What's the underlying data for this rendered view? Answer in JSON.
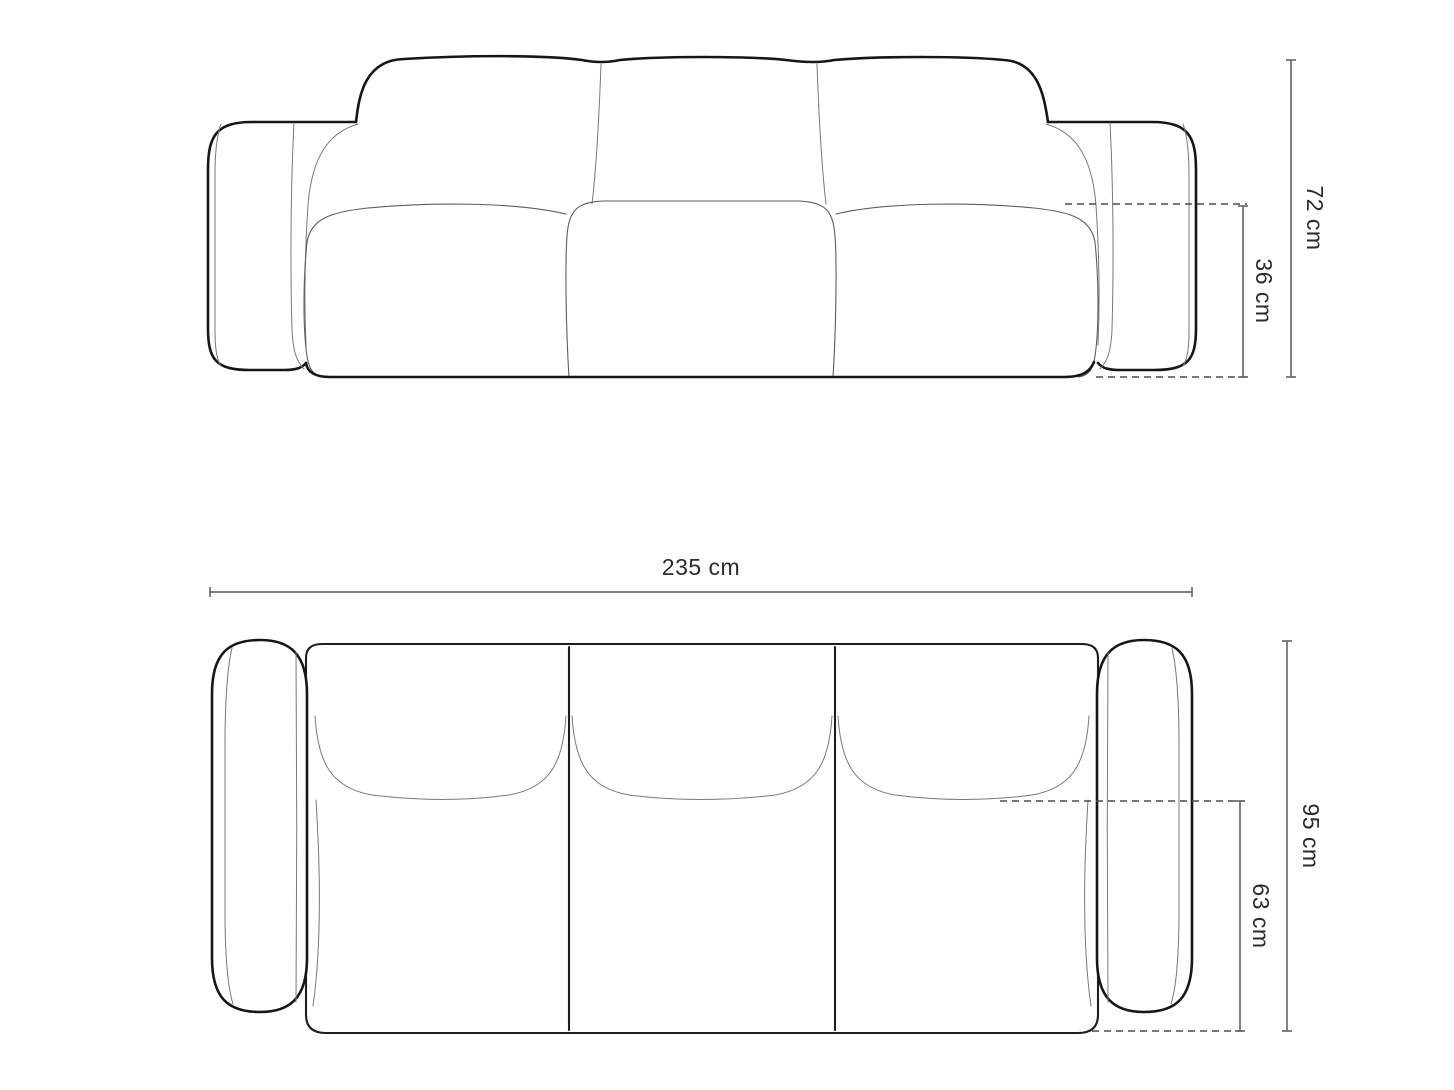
{
  "diagram": {
    "type": "furniture-dimension-drawing",
    "subject": "3-seat sofa, front elevation and top plan views",
    "colors": {
      "background": "#ffffff",
      "outline": "#161616",
      "seam": "#787878",
      "dimension_line": "#6b6b6b",
      "dashed_line": "#4a4a4a",
      "label_text": "#2b2b2b"
    },
    "views": [
      {
        "id": "front-elevation",
        "dimensions": [
          {
            "name": "total-height",
            "label": "72 cm"
          },
          {
            "name": "seat-height",
            "label": "36 cm"
          }
        ]
      },
      {
        "id": "top-plan",
        "dimensions": [
          {
            "name": "total-width",
            "label": "235 cm"
          },
          {
            "name": "total-depth",
            "label": "95 cm"
          },
          {
            "name": "seat-depth",
            "label": "63 cm"
          }
        ]
      }
    ]
  }
}
